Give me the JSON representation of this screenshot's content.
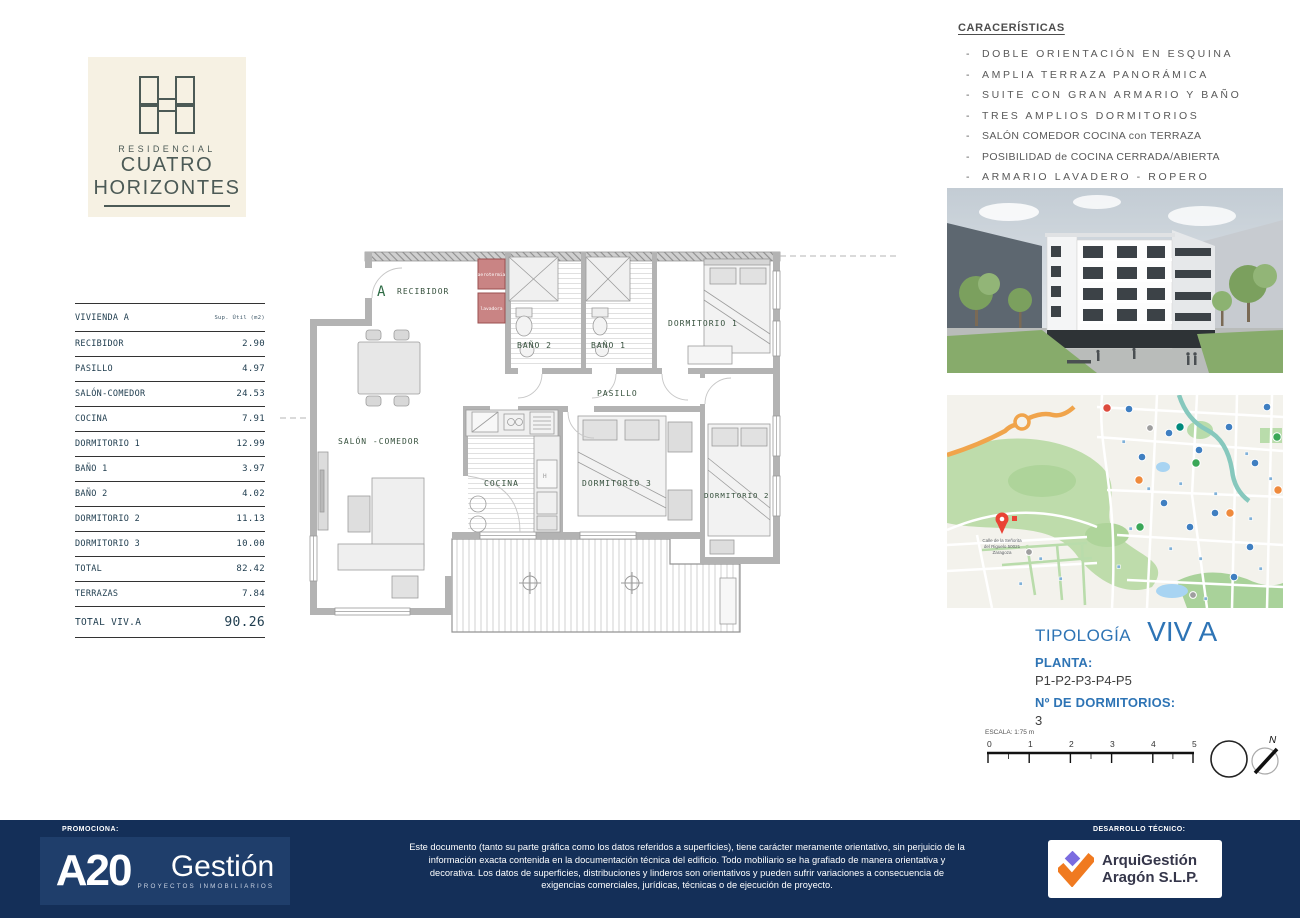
{
  "brand": {
    "residencial": "RESIDENCIAL",
    "name1": "CUATRO",
    "name2": "HORIZONTES"
  },
  "caracteristicas": {
    "title": "CARACERÍSTICAS",
    "bullet": "-",
    "items": [
      {
        "text": "DOBLE ORIENTACIÓN EN ESQUINA"
      },
      {
        "text": "AMPLIA TERRAZA PANORÁMICA"
      },
      {
        "text": "SUITE CON GRAN ARMARIO Y BAÑO"
      },
      {
        "text": "TRES AMPLIOS DORMITORIOS"
      },
      {
        "text": "SALÓN COMEDOR COCINA con TERRAZA"
      },
      {
        "text": "POSIBILIDAD de COCINA CERRADA/ABIERTA"
      },
      {
        "text": "ARMARIO LAVADERO - ROPERO"
      }
    ]
  },
  "surface_table": {
    "title": "VIVIENDA A",
    "unit": "Sup. Útil (m2)",
    "rows": [
      {
        "label": "RECIBIDOR",
        "value": "2.90"
      },
      {
        "label": "PASILLO",
        "value": "4.97"
      },
      {
        "label": "SALÓN-COMEDOR",
        "value": "24.53"
      },
      {
        "label": "COCINA",
        "value": "7.91"
      },
      {
        "label": "DORMITORIO 1",
        "value": "12.99"
      },
      {
        "label": "BAÑO 1",
        "value": "3.97"
      },
      {
        "label": "BAÑO 2",
        "value": "4.02"
      },
      {
        "label": "DORMITORIO 2",
        "value": "11.13"
      },
      {
        "label": "DORMITORIO 3",
        "value": "10.00"
      },
      {
        "label": "TOTAL",
        "value": "82.42"
      },
      {
        "label": "TERRAZAS",
        "value": "7.84"
      },
      {
        "label": "TOTAL VIV.A",
        "value": "90.26"
      }
    ]
  },
  "floorplan": {
    "unit_marker": "A",
    "labels": {
      "recibidor": "RECIBIDOR",
      "bano2": "BAÑO 2",
      "bano1": "BAÑO 1",
      "dormitorio1": "DORMITORIO 1",
      "pasillo": "PASILLO",
      "salon": "SALÓN -COMEDOR",
      "cocina": "COCINA",
      "dormitorio3": "DORMITORIO 3",
      "dormitorio2": "DORMITORIO 2",
      "aerotermia": "aerotermia",
      "lavadora": "lavadora",
      "hob": "H"
    }
  },
  "tipologia": {
    "label": "TIPOLOGÍA",
    "value": "VIV A",
    "planta_label": "PLANTA:",
    "planta_value": "P1-P2-P3-P4-P5",
    "dormitorios_label": "Nº DE DORMITORIOS:",
    "dormitorios_value": "3"
  },
  "scale_bar": {
    "label": "ESCALA: 1:75 m",
    "ticks": [
      "0",
      "1",
      "2",
      "3",
      "4",
      "5"
    ],
    "north": "N"
  },
  "map": {
    "pin_line1": "Calle de la Señorita",
    "pin_line2": "del Riguelo 50021",
    "pin_line3": "Zaragoza"
  },
  "footer": {
    "promociona_label": "PROMOCIONA:",
    "a20_main": "A20",
    "a20_gestion": "Gestión",
    "a20_sub": "PROYECTOS INMOBILIARIOS",
    "disclaimer": "Este documento (tanto su parte gráfica como los datos referidos a superficies), tiene carácter meramente orientativo, sin perjuicio de la información exacta contenida en la documentación técnica del edificio. Todo mobiliario se ha grafiado de manera orientativa y decorativa. Los datos de superficies, distribuciones y linderos son orientativos y pueden sufrir variaciones a consecuencia de exigencias  comerciales, jurídicas, técnicas o de ejecución de proyecto.",
    "desarrollo_label": "DESARROLLO TÉCNICO:",
    "arqui_name1": "ArquiGestión",
    "arqui_name2": "Aragón S.L.P."
  },
  "colors": {
    "accent_blue": "#2e74b5",
    "footer_navy": "#142f58",
    "brand_teal": "#4c5a56",
    "cream": "#f6f1e3",
    "plan_label_green": "#35503c",
    "aerotermia_red": "#c98484",
    "arqui_orange": "#f07a20",
    "arqui_purple": "#7b6ce0"
  }
}
